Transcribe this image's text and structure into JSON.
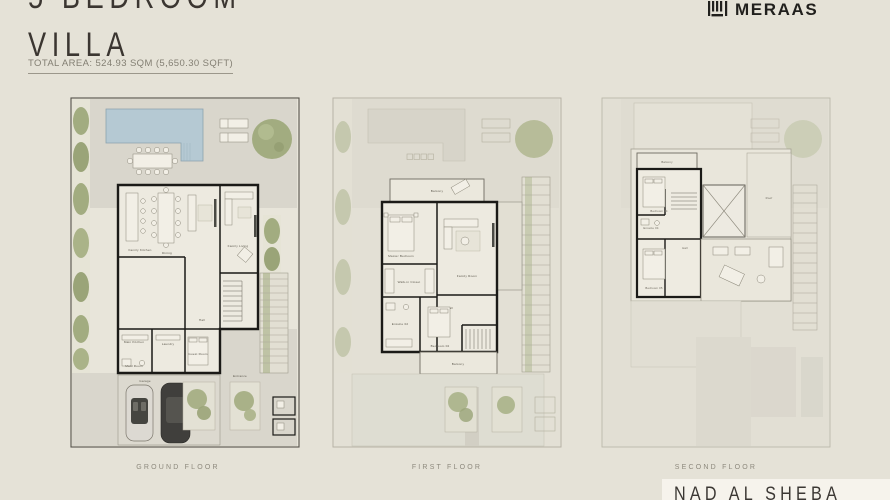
{
  "header": {
    "title_line1": "5 BEDROOM",
    "title_line2": "VILLA",
    "total_area": "TOTAL AREA: 524.93 SQM (5,650.30 SQFT)"
  },
  "brand": {
    "name": "MERAAS"
  },
  "footer": {
    "location": "NAD AL SHEBA"
  },
  "plans": {
    "ground": {
      "label": "GROUND FLOOR",
      "rooms": {
        "family_kitchen": "Family Kitchen",
        "dining": "Dining",
        "family_living": "Family Living",
        "hall": "Hall",
        "main_kitchen": "Main Kitchen",
        "laundry": "Laundry",
        "guest_room": "Guest Room",
        "maid_room": "Maid Room",
        "garage": "Garage",
        "entrance": "Entrance"
      }
    },
    "first": {
      "label": "FIRST FLOOR",
      "rooms": {
        "balcony_top": "Balcony",
        "master_bedroom": "Master Bedroom",
        "walk_in_closet": "Walk-in Closet",
        "family_room": "Family Room",
        "hall": "Hall",
        "ensuite": "Ensuite 02",
        "bedroom_02": "Bedroom 02",
        "balcony_bottom": "Balcony"
      }
    },
    "second": {
      "label": "SECOND FLOOR",
      "rooms": {
        "balcony": "Balcony",
        "bedroom_04": "Bedroom 04",
        "ensuite_04": "Ensuite 04",
        "bedroom_05": "Bedroom 05",
        "hall": "Hall",
        "roof": "Roof"
      }
    }
  },
  "colors": {
    "background": "#e5e2d7",
    "wall": "#1b1a17",
    "pool": "#b5c9d3",
    "greenery": "#a2ac80",
    "paper": "#e8e5da",
    "brand_text": "#21201d",
    "footer_box": "#f6f3ec"
  }
}
